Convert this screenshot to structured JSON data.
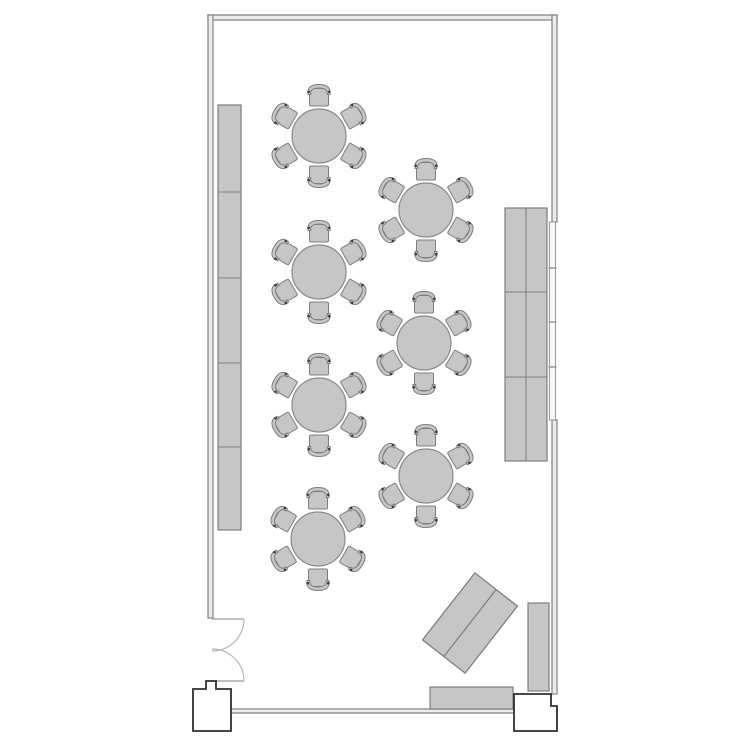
{
  "page": {
    "title": "Room floor plan",
    "background": "#ffffff"
  },
  "canvas": {
    "width": 750,
    "height": 750
  },
  "colors": {
    "wall_stroke": "#8a8a8a",
    "wall_fill": "#ececec",
    "dark_outline": "#2f2f2f",
    "furniture_fill": "#c6c6c6",
    "furniture_stroke": "#7e7e7e",
    "table_fill": "#c6c6c6",
    "table_stroke": "#8a8a8a",
    "chair_accent": "#3a3a3a",
    "door_leaf_stroke": "#9a9a9a",
    "door_arc_stroke": "#b5b5b5",
    "window_stroke": "#9e9e9e",
    "window_fill": "#fafafa",
    "column_fill": "#ffffff"
  },
  "walls": [
    {
      "name": "wall-top",
      "x": 208,
      "y": 15,
      "w": 349,
      "h": 5
    },
    {
      "name": "wall-left",
      "x": 208,
      "y": 15,
      "w": 5,
      "h": 603
    },
    {
      "name": "wall-right-upper",
      "x": 552,
      "y": 15,
      "w": 5,
      "h": 207
    },
    {
      "name": "wall-right-lower",
      "x": 552,
      "y": 420,
      "w": 5,
      "h": 274
    },
    {
      "name": "wall-bottom",
      "x": 231,
      "y": 709,
      "w": 284,
      "h": 4
    }
  ],
  "window": {
    "name": "window-right",
    "x": 549.5,
    "y": 222,
    "w": 6,
    "h": 198,
    "mullions_y": [
      268,
      322,
      367
    ]
  },
  "door": {
    "name": "door-double-swing",
    "leaves": [
      {
        "line": [
          212,
          619,
          244,
          619
        ],
        "arc": "M 244 619 A 32 32 0 0 1 212 651"
      },
      {
        "line": [
          212,
          681,
          244,
          681
        ],
        "arc": "M 244 681 A 32 32 0 0 0 212 649"
      }
    ]
  },
  "columns": [
    {
      "name": "entry-column-left",
      "points": [
        [
          206,
          681
        ],
        [
          216,
          681
        ],
        [
          216,
          689
        ],
        [
          231,
          689
        ],
        [
          231,
          731
        ],
        [
          193,
          731
        ],
        [
          193,
          689
        ],
        [
          206,
          689
        ]
      ]
    },
    {
      "name": "entry-pillar-right",
      "points": [
        [
          514,
          694
        ],
        [
          551,
          694
        ],
        [
          551,
          706
        ],
        [
          557,
          706
        ],
        [
          557,
          731
        ],
        [
          514,
          731
        ]
      ]
    }
  ],
  "counter_left": {
    "name": "wall-counter-left",
    "x": 218,
    "y": 105,
    "w": 23,
    "h": 425,
    "dividers_y": [
      192,
      278,
      363,
      447
    ]
  },
  "cabinet_right": {
    "name": "cabinet-right",
    "x": 505,
    "y": 208,
    "w": 42,
    "h": 253,
    "divider_x": 526,
    "dividers_y": [
      292,
      377
    ]
  },
  "sideboard_right": {
    "name": "sideboard-right",
    "x": 528,
    "y": 603,
    "w": 21,
    "h": 88
  },
  "credenza_bottom": {
    "name": "credenza-bottom",
    "x": 430,
    "y": 687,
    "w": 83,
    "h": 22
  },
  "diagonal_desk": {
    "name": "diagonal-desk",
    "cx": 470,
    "cy": 623,
    "w": 85,
    "h": 54,
    "angle": -52
  },
  "tables": {
    "radius": 27,
    "chair_count": 6,
    "chair_angles": [
      0,
      60,
      120,
      180,
      240,
      300
    ],
    "chair_offset": 38,
    "centers": [
      {
        "cx": 319,
        "cy": 136
      },
      {
        "cx": 319,
        "cy": 272
      },
      {
        "cx": 319,
        "cy": 405
      },
      {
        "cx": 318,
        "cy": 539
      },
      {
        "cx": 426,
        "cy": 210
      },
      {
        "cx": 424,
        "cy": 343
      },
      {
        "cx": 426,
        "cy": 476
      }
    ]
  }
}
